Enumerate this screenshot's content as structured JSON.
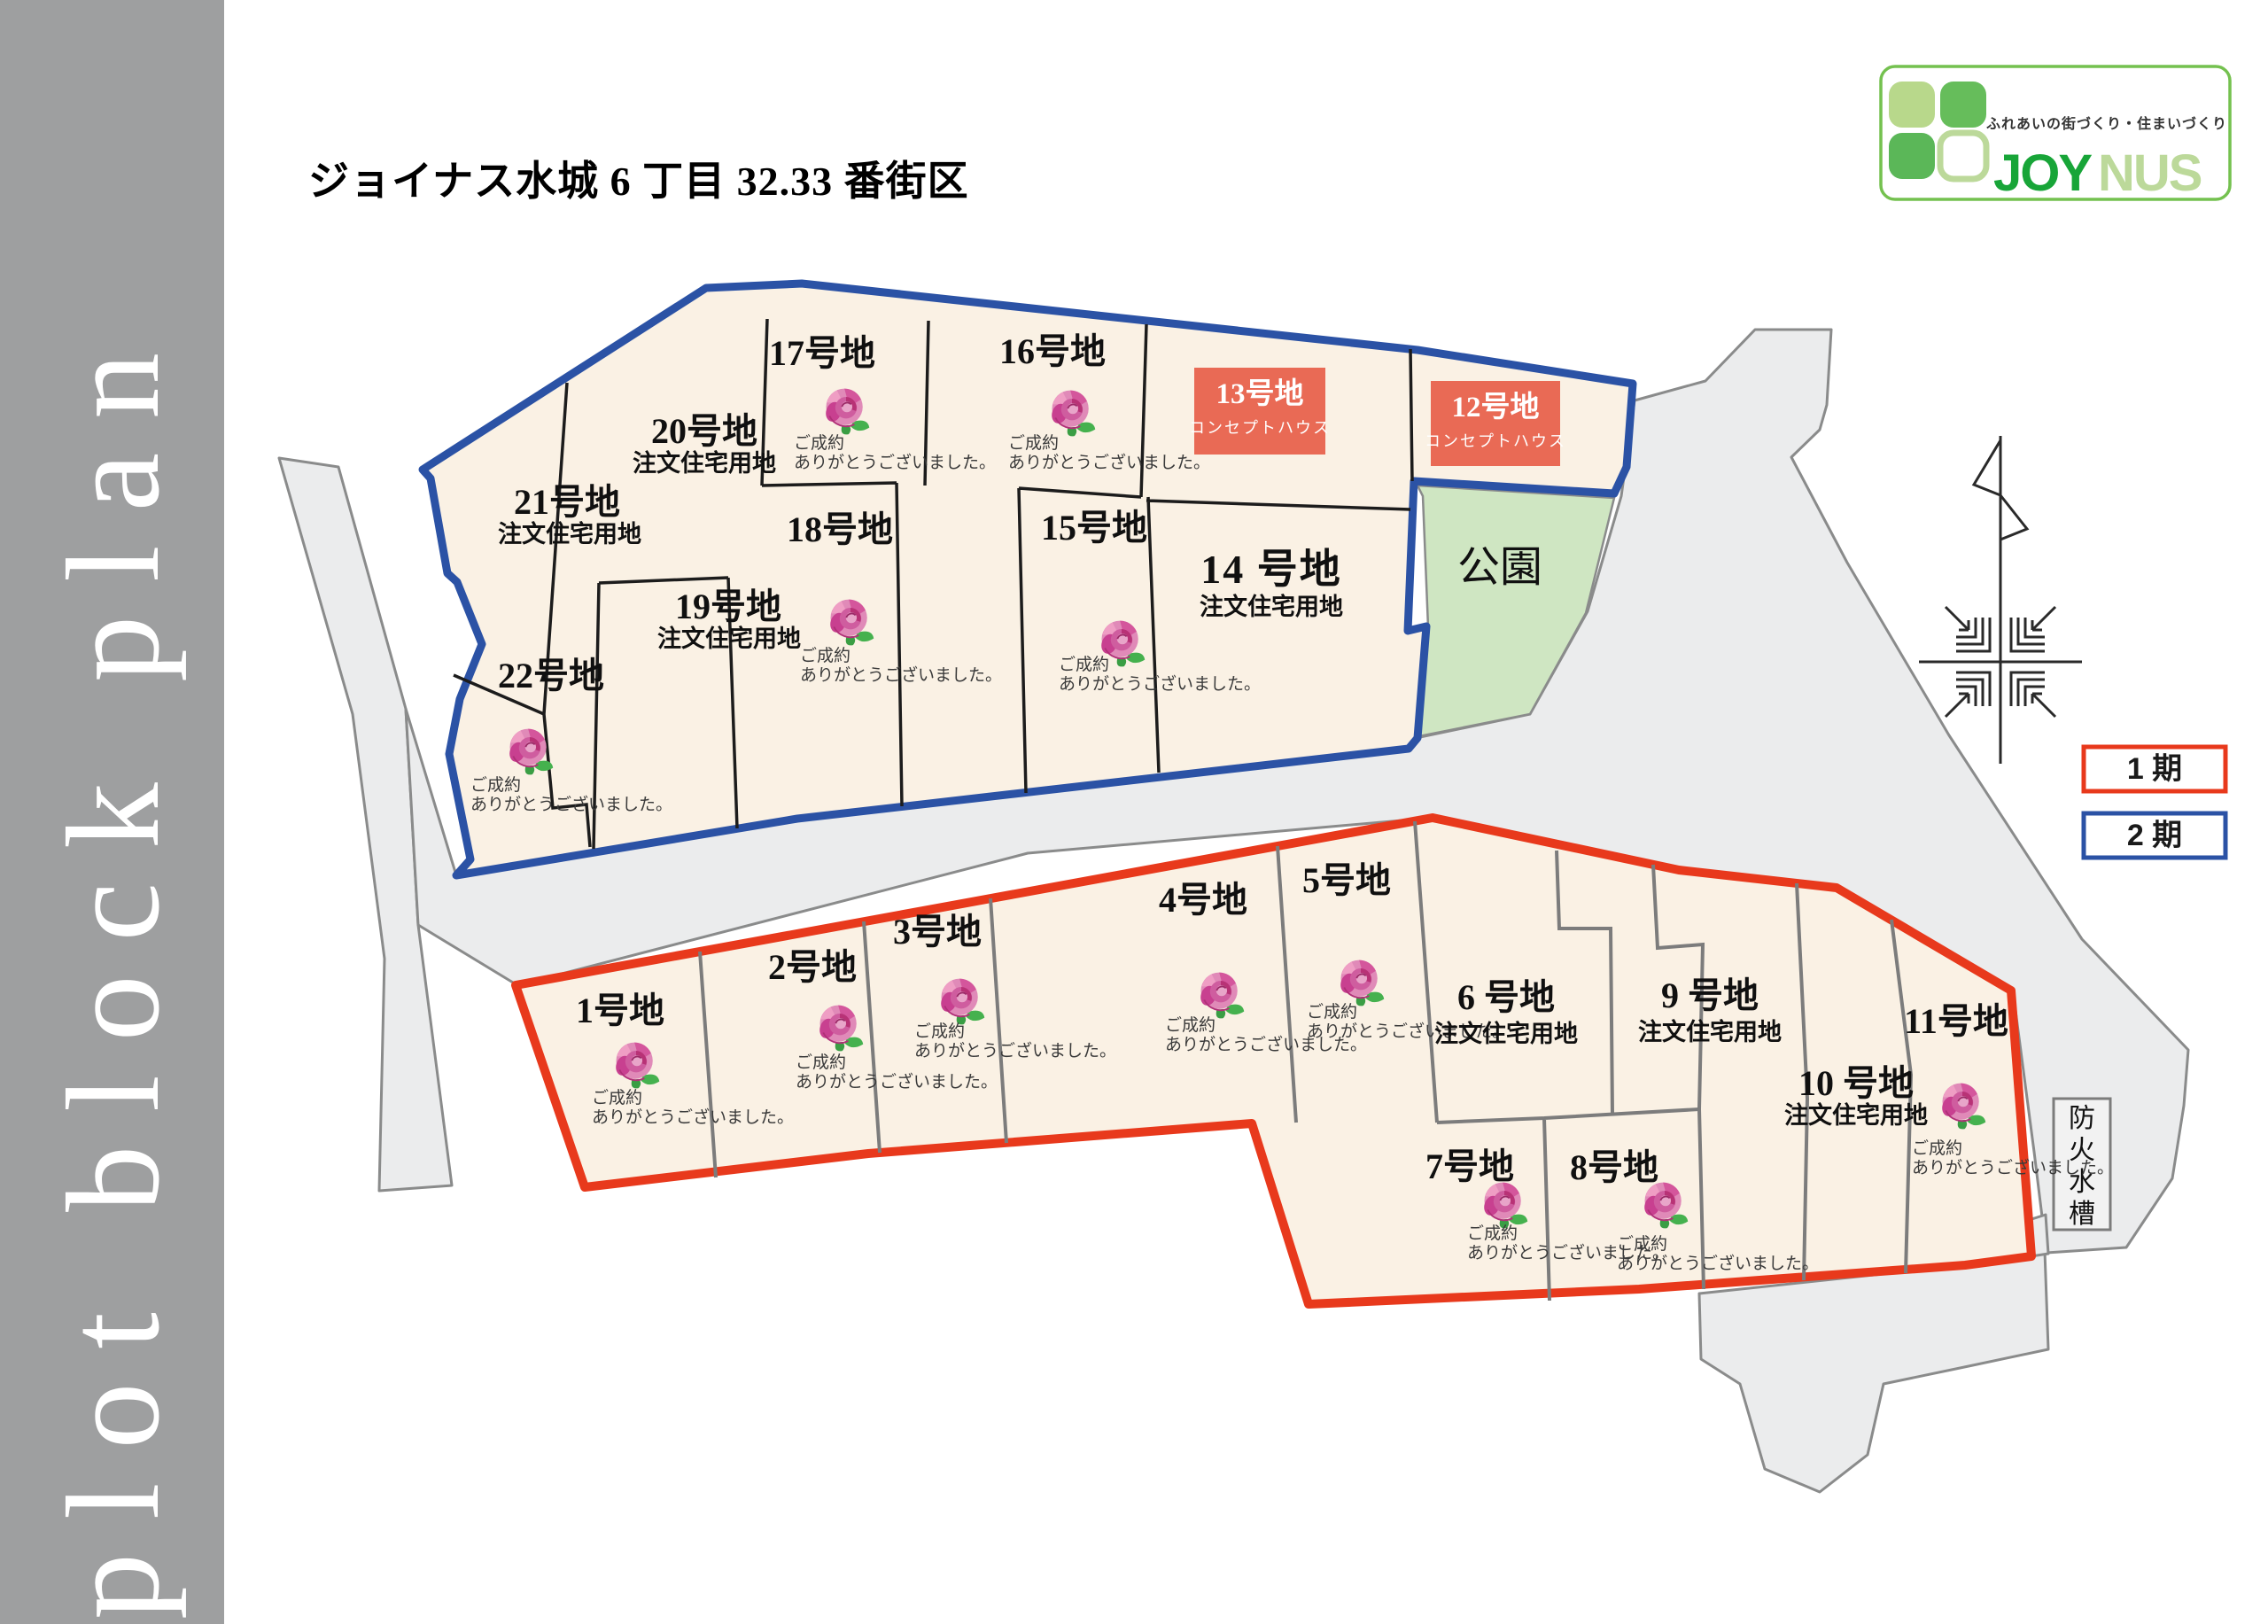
{
  "sidebar": {
    "label": "plot block plan"
  },
  "header": {
    "title": "ジョイナス水城 6 丁目 32.33 番街区"
  },
  "logo": {
    "tagline": "ふれあいの街づくり・住まいづくり",
    "name_bold": "JOY",
    "name_light": "NUS"
  },
  "legend": [
    {
      "label": "1 期",
      "color": "#e8391c"
    },
    {
      "label": "2 期",
      "color": "#2b52a5"
    }
  ],
  "map": {
    "park_label": "公園",
    "fire_cistern_label": "防火水槽",
    "sold_note_line1": "ご成約",
    "sold_note_line2": "ありがとうございました。",
    "custom_home_label": "注文住宅用地",
    "concept_label": "コンセプトハウス"
  },
  "lots": [
    {
      "id": 1,
      "label": "1号地",
      "status": "sold"
    },
    {
      "id": 2,
      "label": "2号地",
      "status": "sold"
    },
    {
      "id": 3,
      "label": "3号地",
      "status": "sold"
    },
    {
      "id": 4,
      "label": "4号地",
      "status": "sold"
    },
    {
      "id": 5,
      "label": "5号地",
      "status": "sold"
    },
    {
      "id": 6,
      "label": "6 号地",
      "status": "available",
      "use": "注文住宅用地"
    },
    {
      "id": 7,
      "label": "7号地",
      "status": "sold"
    },
    {
      "id": 8,
      "label": "8号地",
      "status": "sold"
    },
    {
      "id": 9,
      "label": "9 号地",
      "status": "available",
      "use": "注文住宅用地"
    },
    {
      "id": 10,
      "label": "10 号地",
      "status": "available",
      "use": "注文住宅用地"
    },
    {
      "id": 11,
      "label": "11号地",
      "status": "sold"
    },
    {
      "id": 12,
      "label": "12号地",
      "status": "concept",
      "badge": "コンセプトハウス"
    },
    {
      "id": 13,
      "label": "13号地",
      "status": "concept",
      "badge": "コンセプトハウス"
    },
    {
      "id": 14,
      "label": "14 号地",
      "status": "available",
      "use": "注文住宅用地"
    },
    {
      "id": 15,
      "label": "15号地",
      "status": "sold"
    },
    {
      "id": 16,
      "label": "16号地",
      "status": "sold"
    },
    {
      "id": 17,
      "label": "17号地",
      "status": "sold"
    },
    {
      "id": 18,
      "label": "18号地",
      "status": "sold"
    },
    {
      "id": 19,
      "label": "19号地",
      "status": "available",
      "use": "注文住宅用地"
    },
    {
      "id": 20,
      "label": "20号地",
      "status": "available",
      "use": "注文住宅用地"
    },
    {
      "id": 21,
      "label": "21号地",
      "status": "available",
      "use": "注文住宅用地"
    },
    {
      "id": 22,
      "label": "22号地",
      "status": "sold"
    }
  ],
  "colors": {
    "phase1": "#e8391c",
    "phase2": "#2b52a5",
    "lot_fill": "#faf1e4",
    "road": "#ebeced",
    "park": "#cfe6c2",
    "concept_box": "#e96a55",
    "sidebar": "#9e9fa0",
    "logo_green": "#18a538",
    "logo_light_green": "#bcd99a"
  }
}
